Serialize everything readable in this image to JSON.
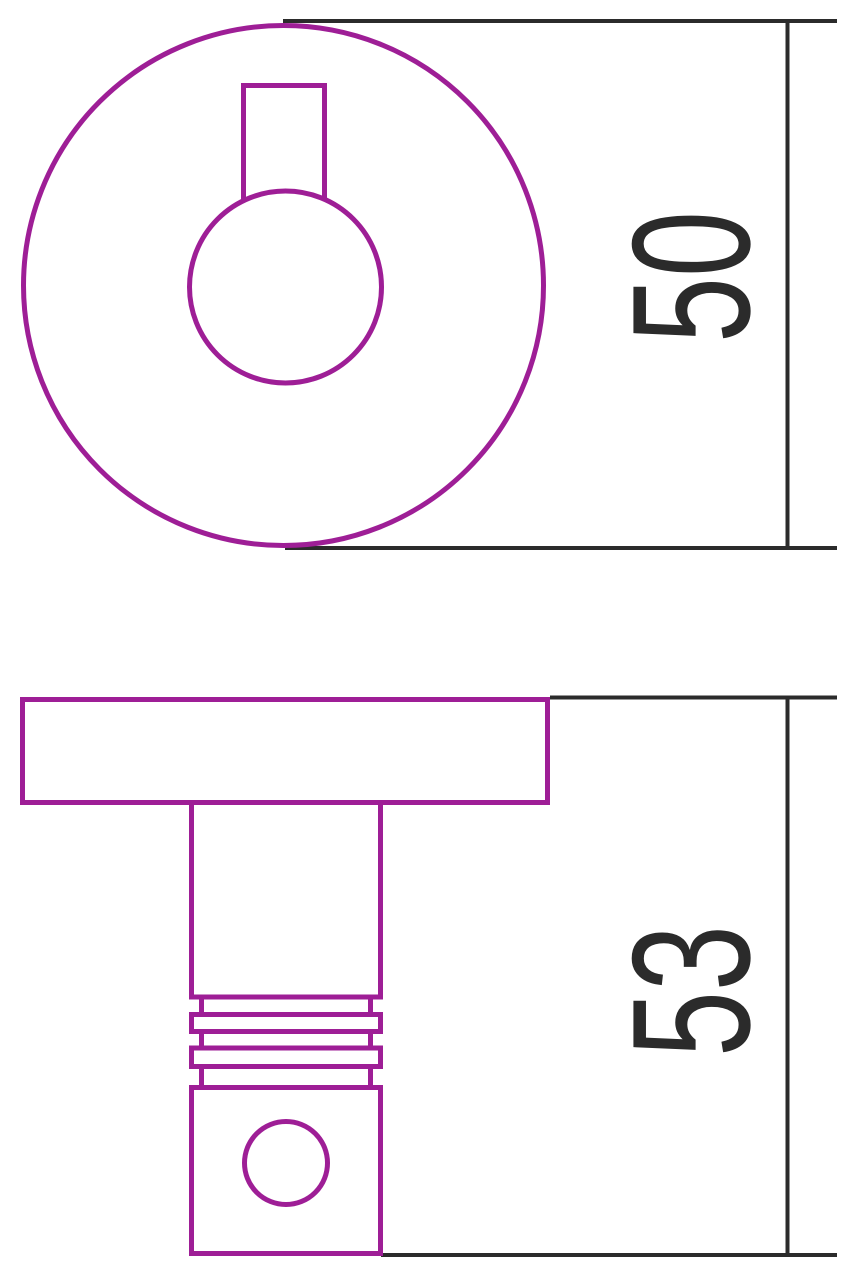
{
  "colors": {
    "outline": "#9E1E96",
    "dimension": "#2B2B2B",
    "background": "#FFFFFF"
  },
  "dimensions": {
    "front_view_height": "50",
    "side_view_height": "53"
  }
}
